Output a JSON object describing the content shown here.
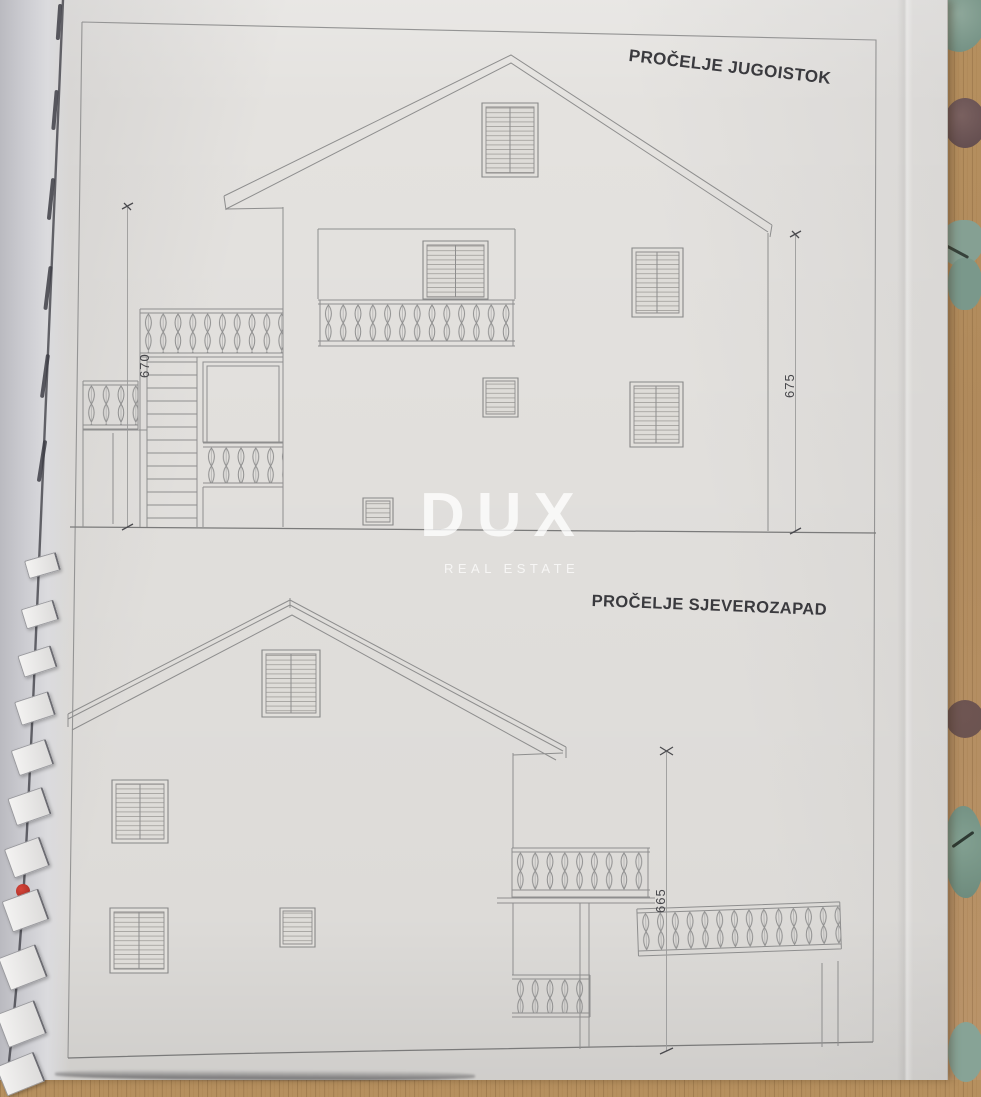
{
  "sheet": {
    "watermark": {
      "brand": "DUX",
      "tagline": "REAL ESTATE"
    },
    "elevations": [
      {
        "title": "PROČELJE JUGOISTOK",
        "dimensions": [
          {
            "value": "670"
          },
          {
            "value": "675"
          }
        ]
      },
      {
        "title": "PROČELJE SJEVEROZAPAD",
        "dimensions": [
          {
            "value": "665"
          }
        ]
      }
    ]
  },
  "materials": {
    "paper_color": "#e4e2df",
    "line_color": "#8e8e8e",
    "title_color": "#3a3a3e",
    "wood_color": "#b6905f",
    "fabric_color": "#85a093",
    "binding_accent": "#c23b2e"
  }
}
